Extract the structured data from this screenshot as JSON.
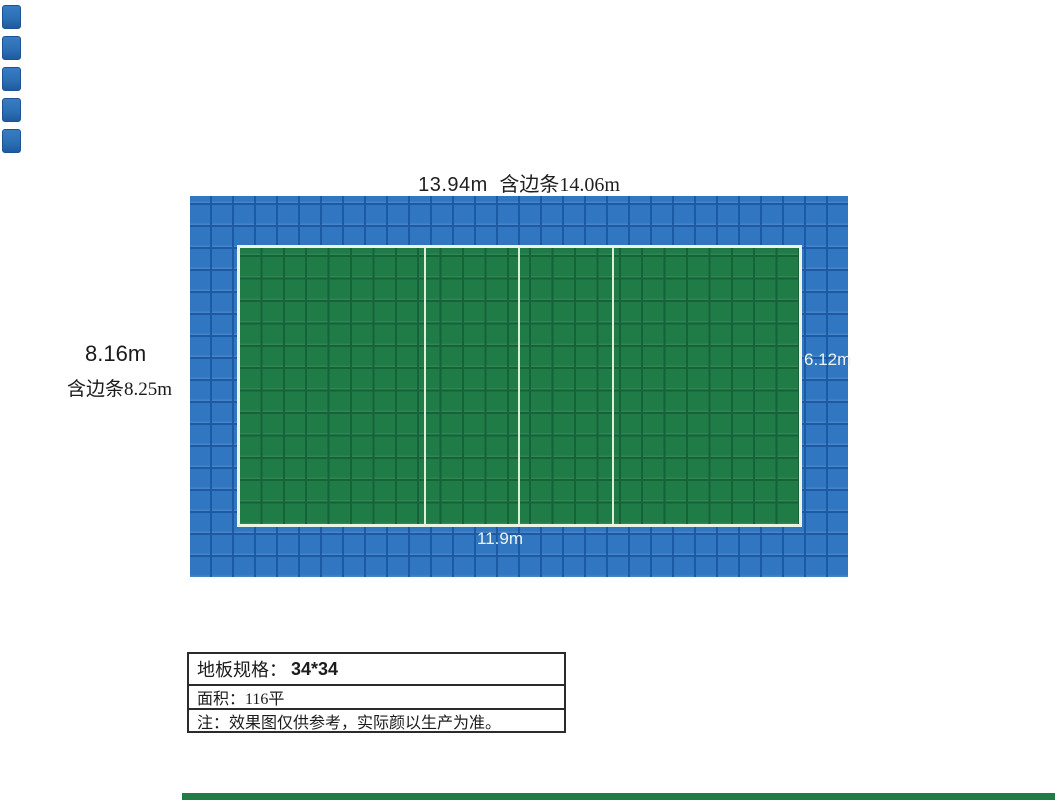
{
  "colors": {
    "tile_blue": "#3176c1",
    "tile_blue_grid_line": "#1d5aa4",
    "court_green": "#1f7c46",
    "court_green_grid_line": "#166239",
    "court_boundary_white": "#e9f4e6",
    "swatch_blue": "#2d6fb5",
    "bottom_strip_green": "#1e7c46",
    "label_dark": "#1f1f1f",
    "label_white": "#edf3ee"
  },
  "dimensions": {
    "top": {
      "main": "13.94m",
      "with_edge": "含边条14.06m"
    },
    "left": {
      "main": "8.16m",
      "with_edge": "含边条8.25m"
    },
    "court_height": "6.12m",
    "court_width": "11.9m"
  },
  "spec_table": {
    "rows": [
      {
        "label": "地板规格：",
        "value": "34*34"
      },
      {
        "label": "面积：",
        "value": "116平"
      },
      {
        "label": "注：",
        "value": "效果图仅供参考，实际颜以生产为准。"
      }
    ]
  }
}
